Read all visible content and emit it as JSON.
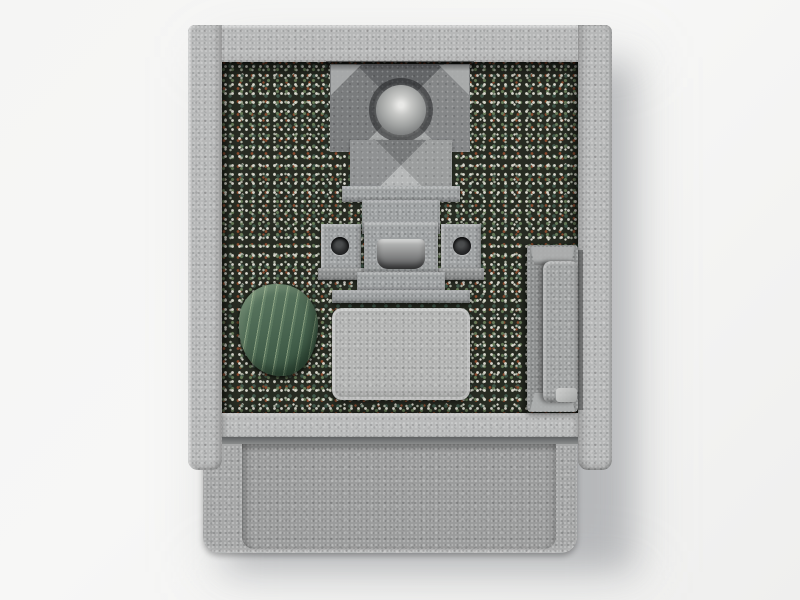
{
  "scene": {
    "description": "Top-down 3D architectural render of a Japanese family grave plot: a light-gray granite perimeter frame encloses a bed of multicolored gravel with a central granite monument (roof slab with ball ornament, cap stone, body, twin flower stands with round vase holes, incense burner with recessed tray and stepped bases), a rounded paving slab, a green serpentine stepping stone, a narrow granite bench on the right, and a recessed entrance platform at the front.",
    "objects": [
      {
        "id": "grave-plot",
        "label": "grave plot"
      },
      {
        "id": "gravel-bed",
        "label": "multicolored gravel bed"
      },
      {
        "id": "monument",
        "label": "central granite monument"
      },
      {
        "id": "ornament-sphere",
        "label": "ball ornament"
      },
      {
        "id": "flower-stand-left",
        "label": "left flower stand with vase hole"
      },
      {
        "id": "flower-stand-right",
        "label": "right flower stand with vase hole"
      },
      {
        "id": "incense-burner",
        "label": "incense burner with recessed tray"
      },
      {
        "id": "paving-slab",
        "label": "granite paving slab"
      },
      {
        "id": "stepping-stone",
        "label": "green serpentine stepping stone"
      },
      {
        "id": "bench",
        "label": "granite bench"
      },
      {
        "id": "entrance-step",
        "label": "front step band"
      },
      {
        "id": "entrance-platform",
        "label": "recessed entrance platform"
      },
      {
        "id": "perimeter-frame",
        "label": "granite perimeter frame"
      }
    ]
  },
  "colors": {
    "bg": "#f5f5f4",
    "granite-frame": "#b7b8b8",
    "granite-step": "#b9baba",
    "granite-platform": "#a6a7a7",
    "granite-recess": "#9b9c9c",
    "granite-monument": "#9da0a1",
    "granite-monument-light": "#aeb0b0",
    "granite-slab": "#b3b4b3",
    "granite-bench": "#8f9191",
    "granite-bench-slab": "#a2a4a4",
    "gravel-base": "#272b22",
    "gravel-white": "#d9d8ce",
    "gravel-gray": "#a9afa0",
    "gravel-green": "#687c5a",
    "gravel-rust": "#8a4b2f",
    "gravel-teal": "#41584b",
    "stone-green": "#41614b",
    "stone-vein": "#cfe0b4",
    "sphere-hi": "#e8e8e6"
  }
}
